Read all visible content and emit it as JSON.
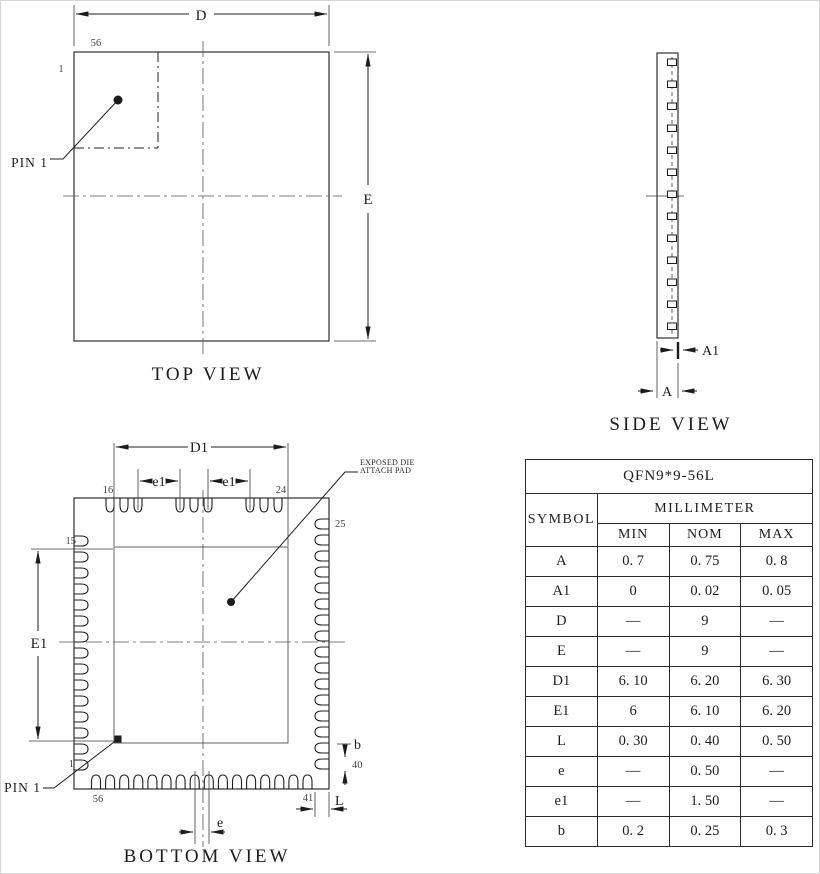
{
  "views": {
    "top": {
      "title": "TOP VIEW",
      "dim_d": "D",
      "dim_e": "E",
      "pin_last": "56",
      "pin_first": "1",
      "pin1_callout": "PIN 1"
    },
    "side": {
      "title": "SIDE VIEW",
      "dim_a": "A",
      "dim_a1": "A1"
    },
    "bottom": {
      "title": "BOTTOM VIEW",
      "dim_d1": "D1",
      "dim_E1": "E1",
      "dim_e1_left": "e1",
      "dim_e1_right": "e1",
      "dim_e": "e",
      "dim_b": "b",
      "dim_l": "L",
      "pin1_callout": "PIN 1",
      "exposed_pad_note_line1": "EXPOSED DIE",
      "exposed_pad_note_line2": "ATTACH PAD",
      "pin_labels": {
        "p1": "1",
        "p15": "15",
        "p16": "16",
        "p24": "24",
        "p25": "25",
        "p40": "40",
        "p41": "41",
        "p56": "56"
      }
    }
  },
  "table": {
    "title": "QFN9*9-56L",
    "symbol_header": "SYMBOL",
    "unit_header": "MILLIMETER",
    "columns": [
      "MIN",
      "NOM",
      "MAX"
    ],
    "rows": [
      {
        "symbol": "A",
        "min": "0. 7",
        "nom": "0. 75",
        "max": "0. 8"
      },
      {
        "symbol": "A1",
        "min": "0",
        "nom": "0. 02",
        "max": "0. 05"
      },
      {
        "symbol": "D",
        "min": "—",
        "nom": "9",
        "max": "—"
      },
      {
        "symbol": "E",
        "min": "—",
        "nom": "9",
        "max": "—"
      },
      {
        "symbol": "D1",
        "min": "6. 10",
        "nom": "6. 20",
        "max": "6. 30"
      },
      {
        "symbol": "E1",
        "min": "6",
        "nom": "6. 10",
        "max": "6. 20"
      },
      {
        "symbol": "L",
        "min": "0. 30",
        "nom": "0. 40",
        "max": "0. 50"
      },
      {
        "symbol": "e",
        "min": "—",
        "nom": "0. 50",
        "max": "—"
      },
      {
        "symbol": "e1",
        "min": "—",
        "nom": "1. 50",
        "max": "—"
      },
      {
        "symbol": "b",
        "min": "0. 2",
        "nom": "0. 25",
        "max": "0. 3"
      }
    ]
  },
  "colors": {
    "line": "#1c1c1c",
    "centerline": "#555555",
    "background": "#ffffff"
  }
}
